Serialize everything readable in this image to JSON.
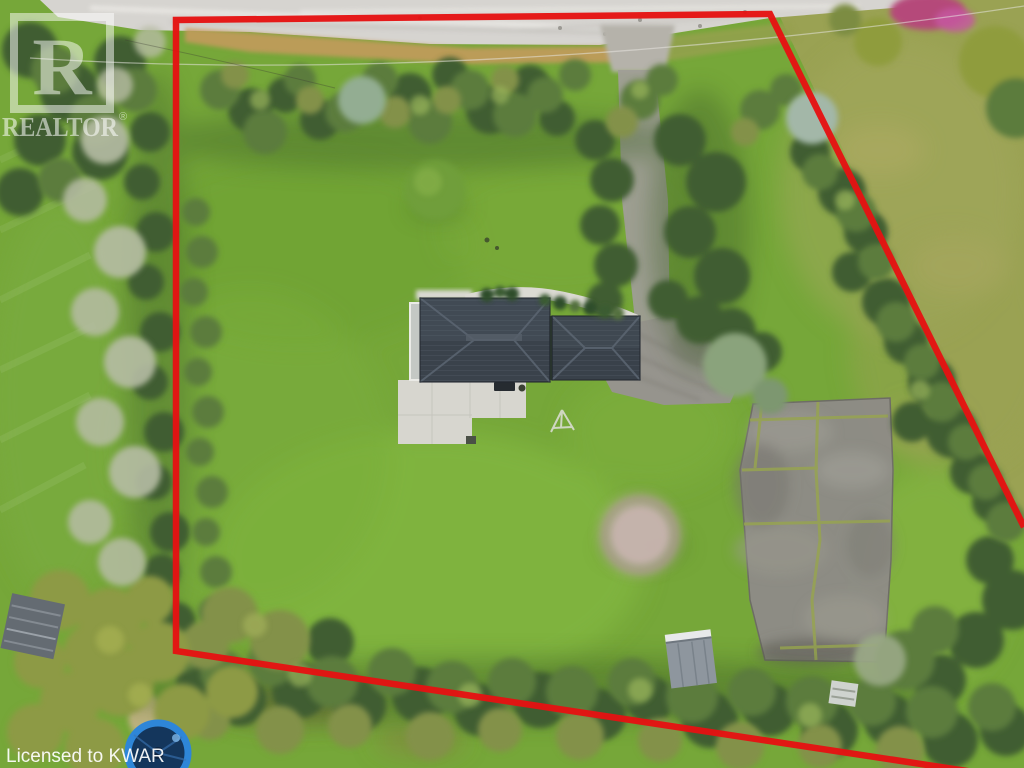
{
  "meta": {
    "type": "aerial-drone-photograph",
    "subject": "rural residential property listing photo with outlined lot",
    "width": 1024,
    "height": 768
  },
  "watermark": {
    "logo_letter": "R",
    "brand": "REALTOR",
    "registered": "®",
    "license": "Licensed to KWAR"
  },
  "boundary": {
    "color": "#e51212",
    "description": "red polygon outlining property lot"
  },
  "scene_palette": {
    "lawn_green": "#76a739",
    "outside_lawn_olive": "#9aa253",
    "road_gray": "#d6d4d0",
    "shoulder_tan": "#c89a5e",
    "roof_slate": "#3a424b",
    "driveway_gray": "#98968f",
    "court_gray": "#8e8c86",
    "crack_moss": "#97a351",
    "trampoline_blue": "#2e86d8",
    "pink_shrub": "#b5487a"
  }
}
